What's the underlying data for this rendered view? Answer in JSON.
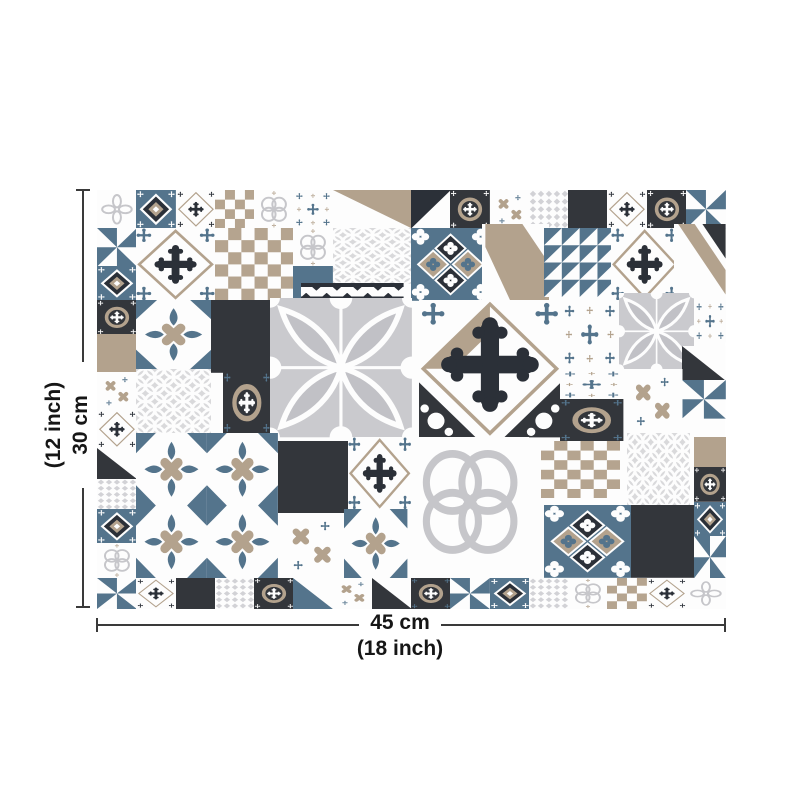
{
  "diagram": {
    "type": "product-dimension-diagram",
    "subject": "patchwork-tile-sheet",
    "width": {
      "primary": "45 cm",
      "secondary": "(18 inch)"
    },
    "height": {
      "primary": "30 cm",
      "secondary": "(12 inch)"
    }
  },
  "palette": {
    "white": "#fdfdfd",
    "charcoal": "#33363b",
    "navy": "#2b3038",
    "slate": "#54748c",
    "tan": "#b3a28d",
    "tan2": "#b5a48f",
    "gray": "#c6c6ca",
    "lgray": "#d2d2d6",
    "lgray2": "#d9d9db",
    "gray_bg": "#cacace",
    "gray_petal": "#c1c1c6",
    "line": "#3a3a3a"
  },
  "grid": {
    "unit_x": 39.25,
    "unit_y": 38,
    "cols": 16,
    "rows": 11
  },
  "tiles": [
    {
      "x": 0,
      "y": 0,
      "w": 1,
      "h": 1,
      "t": "petals"
    },
    {
      "x": 1,
      "y": 0,
      "w": 1,
      "h": 1,
      "t": "dnavy"
    },
    {
      "x": 2,
      "y": 0,
      "w": 1,
      "h": 1,
      "t": "xcross"
    },
    {
      "x": 3,
      "y": 0,
      "w": 1,
      "h": 1,
      "t": "checker_s"
    },
    {
      "x": 4,
      "y": 0,
      "w": 1,
      "h": 1,
      "t": "qring"
    },
    {
      "x": 5,
      "y": 0,
      "w": 1,
      "h": 1,
      "t": "crosses"
    },
    {
      "x": 6,
      "y": 0,
      "w": 2,
      "h": 1,
      "t": "tri_tan"
    },
    {
      "x": 8,
      "y": 0,
      "w": 1,
      "h": 1,
      "t": "tri_navy2"
    },
    {
      "x": 9,
      "y": 0,
      "w": 1,
      "h": 1,
      "t": "ocircle"
    },
    {
      "x": 10,
      "y": 0,
      "w": 1,
      "h": 1,
      "t": "xx"
    },
    {
      "x": 11,
      "y": 0,
      "w": 1,
      "h": 1,
      "t": "lattice"
    },
    {
      "x": 12,
      "y": 0,
      "w": 1,
      "h": 1,
      "t": "dark"
    },
    {
      "x": 13,
      "y": 0,
      "w": 1,
      "h": 1,
      "t": "xcross"
    },
    {
      "x": 14,
      "y": 0,
      "w": 1,
      "h": 1,
      "t": "ocircle"
    },
    {
      "x": 15,
      "y": 0,
      "w": 1,
      "h": 1,
      "t": "pin_blue"
    },
    {
      "x": 0,
      "y": 1,
      "w": 1,
      "h": 1,
      "t": "pin_blue"
    },
    {
      "x": 0,
      "y": 2,
      "w": 1,
      "h": 0.9,
      "t": "dnavy"
    },
    {
      "x": 0,
      "y": 2.9,
      "w": 1,
      "h": 0.9,
      "t": "ocircle"
    },
    {
      "x": 0,
      "y": 3.8,
      "w": 1,
      "h": 1,
      "t": "tan_s"
    },
    {
      "x": 0,
      "y": 4.8,
      "w": 1,
      "h": 1,
      "t": "xx"
    },
    {
      "x": 0,
      "y": 5.8,
      "w": 1,
      "h": 1,
      "t": "xcross"
    },
    {
      "x": 0,
      "y": 6.8,
      "w": 1,
      "h": 0.8,
      "t": "tri_dark"
    },
    {
      "x": 0,
      "y": 7.6,
      "w": 1,
      "h": 0.8,
      "t": "lattice"
    },
    {
      "x": 0,
      "y": 8.4,
      "w": 1,
      "h": 0.9,
      "t": "dnavy"
    },
    {
      "x": 0,
      "y": 9.3,
      "w": 1,
      "h": 0.9,
      "t": "qring"
    },
    {
      "x": 1,
      "y": 1,
      "w": 2,
      "h": 1.9,
      "t": "xdiamond"
    },
    {
      "x": 3,
      "y": 1,
      "w": 2,
      "h": 1.9,
      "t": "checker"
    },
    {
      "x": 5,
      "y": 1,
      "w": 1,
      "h": 1,
      "t": "qring"
    },
    {
      "x": 5,
      "y": 2,
      "w": 1,
      "h": 0.85,
      "t": "blue_s"
    },
    {
      "x": 6,
      "y": 1,
      "w": 2,
      "h": 1.45,
      "t": "lattice2"
    },
    {
      "x": 8,
      "y": 1,
      "w": 2,
      "h": 1.9,
      "t": "bluediamond"
    },
    {
      "x": 9.8,
      "y": 0.9,
      "w": 1.7,
      "h": 2,
      "t": "tanband2"
    },
    {
      "x": 11.4,
      "y": 1,
      "w": 1.8,
      "h": 1.8,
      "t": "pin_blue4"
    },
    {
      "x": 13.1,
      "y": 1,
      "w": 1.7,
      "h": 1.9,
      "t": "xdiamond"
    },
    {
      "x": 14.7,
      "y": 0.9,
      "w": 1.3,
      "h": 2,
      "t": "tanband"
    },
    {
      "x": 1,
      "y": 2.9,
      "w": 1.9,
      "h": 1.8,
      "t": "batons_w"
    },
    {
      "x": 2.9,
      "y": 2.9,
      "w": 1.5,
      "h": 1.9,
      "t": "dark"
    },
    {
      "x": 5.2,
      "y": 2.45,
      "w": 2.6,
      "h": 0.42,
      "t": "navy_zigzag"
    },
    {
      "x": 4.4,
      "y": 2.85,
      "w": 3.6,
      "h": 3.65,
      "t": "flower"
    },
    {
      "x": 1,
      "y": 4.7,
      "w": 1.9,
      "h": 1.7,
      "t": "lattice2"
    },
    {
      "x": 3.2,
      "y": 4.8,
      "w": 1.2,
      "h": 1.6,
      "t": "ocircle2"
    },
    {
      "x": 8.2,
      "y": 2.9,
      "w": 3.6,
      "h": 3.6,
      "t": "xdiamond_xl"
    },
    {
      "x": 11.8,
      "y": 2.9,
      "w": 1.5,
      "h": 1.8,
      "t": "crosses"
    },
    {
      "x": 13.3,
      "y": 2.7,
      "w": 1.9,
      "h": 2,
      "t": "flower_s"
    },
    {
      "x": 15.2,
      "y": 2.9,
      "w": 0.8,
      "h": 1.1,
      "t": "crosses"
    },
    {
      "x": 14.9,
      "y": 4.1,
      "w": 1.1,
      "h": 0.9,
      "t": "tri_dark"
    },
    {
      "x": 14.9,
      "y": 5,
      "w": 1.1,
      "h": 1,
      "t": "pin_blue"
    },
    {
      "x": 13.4,
      "y": 4.7,
      "w": 1.5,
      "h": 1.7,
      "t": "xx"
    },
    {
      "x": 11.8,
      "y": 4.7,
      "w": 1.6,
      "h": 0.8,
      "t": "crosses"
    },
    {
      "x": 11.8,
      "y": 5.5,
      "w": 1.6,
      "h": 1.1,
      "t": "ocircle2"
    },
    {
      "x": 1,
      "y": 6.4,
      "w": 3.6,
      "h": 3.8,
      "t": "batons4"
    },
    {
      "x": 4.6,
      "y": 6.6,
      "w": 1.8,
      "h": 1.9,
      "t": "dark"
    },
    {
      "x": 6.4,
      "y": 6.5,
      "w": 1.6,
      "h": 1.9,
      "t": "xdiamond"
    },
    {
      "x": 4.6,
      "y": 8.5,
      "w": 1.7,
      "h": 1.7,
      "t": "xx"
    },
    {
      "x": 6.3,
      "y": 8.4,
      "w": 1.6,
      "h": 1.8,
      "t": "batons_w"
    },
    {
      "x": 8,
      "y": 6.5,
      "w": 3,
      "h": 3.4,
      "t": "bigquatrefoil"
    },
    {
      "x": 11.3,
      "y": 6.6,
      "w": 2,
      "h": 1.5,
      "t": "checker"
    },
    {
      "x": 13.5,
      "y": 6.4,
      "w": 1.6,
      "h": 1.9,
      "t": "lattice2"
    },
    {
      "x": 15.2,
      "y": 6.5,
      "w": 0.8,
      "h": 0.8,
      "t": "tan_s"
    },
    {
      "x": 15.2,
      "y": 7.3,
      "w": 0.8,
      "h": 0.9,
      "t": "ocircle"
    },
    {
      "x": 15.2,
      "y": 8.2,
      "w": 0.8,
      "h": 0.9,
      "t": "dnavy"
    },
    {
      "x": 15.2,
      "y": 9.1,
      "w": 0.8,
      "h": 1.1,
      "t": "pin_blue"
    },
    {
      "x": 11.4,
      "y": 8.3,
      "w": 2.2,
      "h": 1.9,
      "t": "bluediamond"
    },
    {
      "x": 13.6,
      "y": 8.3,
      "w": 1.6,
      "h": 1.9,
      "t": "dark"
    },
    {
      "x": 0,
      "y": 10.2,
      "w": 1,
      "h": 0.8,
      "t": "pin_blue"
    },
    {
      "x": 1,
      "y": 10.2,
      "w": 1,
      "h": 0.8,
      "t": "xcross"
    },
    {
      "x": 2,
      "y": 10.2,
      "w": 1,
      "h": 0.8,
      "t": "dark"
    },
    {
      "x": 3,
      "y": 10.2,
      "w": 1,
      "h": 0.8,
      "t": "lattice"
    },
    {
      "x": 4,
      "y": 10.2,
      "w": 1,
      "h": 0.8,
      "t": "ocircle"
    },
    {
      "x": 5,
      "y": 10.2,
      "w": 1,
      "h": 0.8,
      "t": "tri_navy"
    },
    {
      "x": 6,
      "y": 10.2,
      "w": 1,
      "h": 0.8,
      "t": "xx"
    },
    {
      "x": 7,
      "y": 10.2,
      "w": 1,
      "h": 0.8,
      "t": "tri_dark"
    },
    {
      "x": 8,
      "y": 10.2,
      "w": 1,
      "h": 0.8,
      "t": "ocircle2"
    },
    {
      "x": 9,
      "y": 10.2,
      "w": 1,
      "h": 0.8,
      "t": "pin_blue"
    },
    {
      "x": 10,
      "y": 10.2,
      "w": 1,
      "h": 0.8,
      "t": "dnavy"
    },
    {
      "x": 11,
      "y": 10.2,
      "w": 1,
      "h": 0.8,
      "t": "lattice"
    },
    {
      "x": 12,
      "y": 10.2,
      "w": 1,
      "h": 0.8,
      "t": "qring"
    },
    {
      "x": 13,
      "y": 10.2,
      "w": 1,
      "h": 0.8,
      "t": "checker_s"
    },
    {
      "x": 14,
      "y": 10.2,
      "w": 1,
      "h": 0.8,
      "t": "xcross"
    },
    {
      "x": 15,
      "y": 10.2,
      "w": 1,
      "h": 0.8,
      "t": "petals"
    }
  ]
}
